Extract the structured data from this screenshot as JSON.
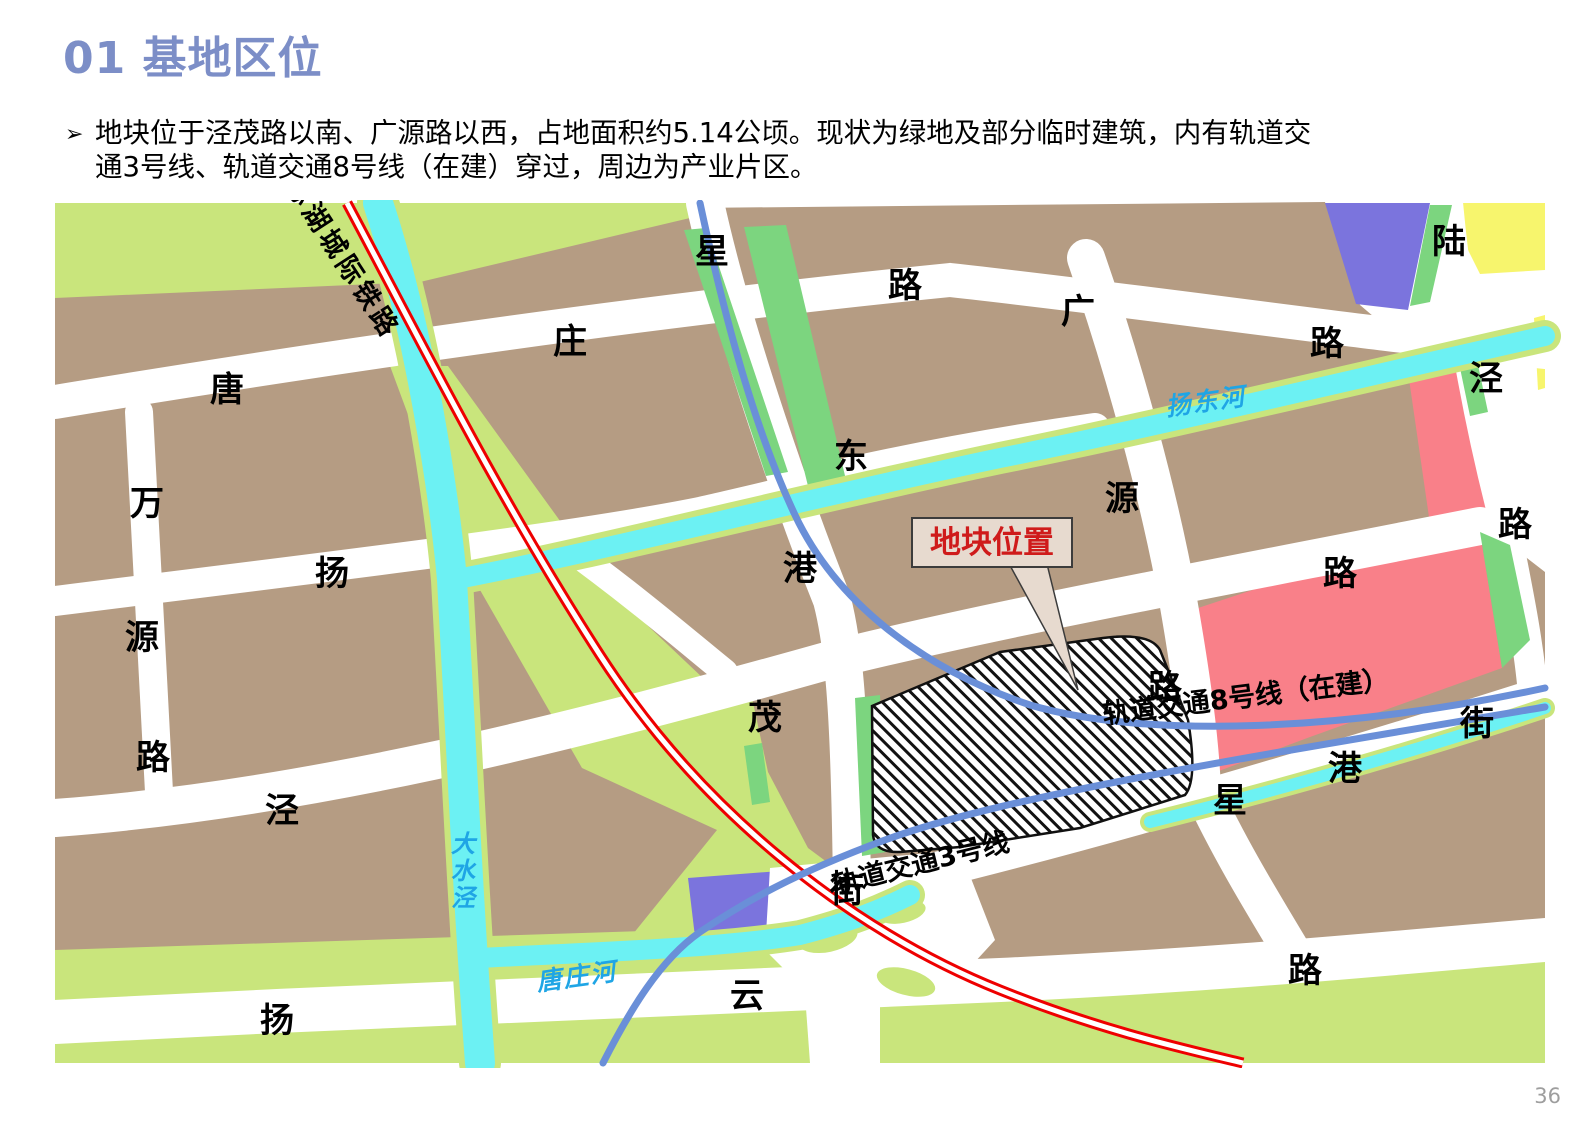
{
  "page": {
    "title": "01 基地区位",
    "bullet_marker": "➢",
    "bullet_line1": "地块位于泾茂路以南、广源路以西，占地面积约5.14公顷。现状为绿地及部分临时建筑，内有轨道交",
    "bullet_line2": "通3号线、轨道交通8号线（在建）穿过，周边为产业片区。",
    "page_number": "36"
  },
  "colors": {
    "title_blue": "#7c8ec7",
    "block_brown": "#b59c83",
    "olive_green": "#c9e57c",
    "strip_green": "#7cd57f",
    "river_cyan": "#6cf1f3",
    "metro_blue": "#6a8fd8",
    "rail_red": "#ee0000",
    "zone_pink": "#f98089",
    "zone_purple": "#7b74dd",
    "zone_yellow": "#f7f56d",
    "callout_bg": "#e7dacf",
    "callout_red": "#cf1b1b",
    "water_label_blue": "#1fa5e5"
  },
  "map": {
    "callout": {
      "text": "地块位置"
    },
    "labels": [
      {
        "name": "rail-label",
        "text": "如通苏湖城际铁路",
        "x": 318,
        "y": 237,
        "size": 27,
        "rot": 57,
        "cls": "rlabel",
        "spacing": 4
      },
      {
        "name": "metro8-label",
        "text": "轨道交通8号线（在建）",
        "x": 1247,
        "y": 706,
        "size": 27,
        "rot": -7,
        "cls": "rlabel",
        "spacing": 0
      },
      {
        "name": "metro3-label",
        "text": "轨道交通3号线",
        "x": 923,
        "y": 872,
        "size": 27,
        "rot": -14,
        "cls": "rlabel",
        "spacing": 0
      },
      {
        "name": "river-label-yangdong",
        "text": "扬东河",
        "x": 1207,
        "y": 410,
        "size": 25,
        "rot": -8,
        "cls": "water",
        "spacing": 2
      },
      {
        "name": "river-label-dashuijing",
        "text": "大水泾",
        "x": 463,
        "y": 852,
        "size": 24,
        "rot": 0,
        "cls": "water",
        "stack": 27
      },
      {
        "name": "river-label-tangzhuang",
        "text": "唐庄河",
        "x": 578,
        "y": 985,
        "size": 25,
        "rot": -8,
        "cls": "water",
        "spacing": 2
      },
      {
        "name": "road-label",
        "text": "星",
        "x": 712,
        "y": 263,
        "size": 34,
        "cls": "rlabel"
      },
      {
        "name": "road-label",
        "text": "路",
        "x": 905,
        "y": 297,
        "size": 34,
        "cls": "rlabel"
      },
      {
        "name": "road-label",
        "text": "庄",
        "x": 570,
        "y": 353,
        "size": 34,
        "cls": "rlabel"
      },
      {
        "name": "road-label",
        "text": "广",
        "x": 1078,
        "y": 323,
        "size": 34,
        "cls": "rlabel"
      },
      {
        "name": "road-label",
        "text": "陆",
        "x": 1449,
        "y": 253,
        "size": 34,
        "cls": "rlabel"
      },
      {
        "name": "road-label",
        "text": "路",
        "x": 1327,
        "y": 355,
        "size": 34,
        "cls": "rlabel"
      },
      {
        "name": "road-label",
        "text": "唐",
        "x": 227,
        "y": 401,
        "size": 34,
        "cls": "rlabel"
      },
      {
        "name": "road-label",
        "text": "泾",
        "x": 1486,
        "y": 390,
        "size": 34,
        "cls": "rlabel"
      },
      {
        "name": "road-label",
        "text": "东",
        "x": 851,
        "y": 468,
        "size": 34,
        "cls": "rlabel"
      },
      {
        "name": "road-label",
        "text": "源",
        "x": 1122,
        "y": 510,
        "size": 34,
        "cls": "rlabel"
      },
      {
        "name": "road-label",
        "text": "万",
        "x": 147,
        "y": 515,
        "size": 34,
        "cls": "rlabel"
      },
      {
        "name": "road-label",
        "text": "港",
        "x": 800,
        "y": 580,
        "size": 34,
        "cls": "rlabel"
      },
      {
        "name": "road-label",
        "text": "路",
        "x": 1515,
        "y": 536,
        "size": 34,
        "cls": "rlabel"
      },
      {
        "name": "road-label",
        "text": "扬",
        "x": 332,
        "y": 585,
        "size": 34,
        "cls": "rlabel"
      },
      {
        "name": "road-label",
        "text": "路",
        "x": 1340,
        "y": 585,
        "size": 34,
        "cls": "rlabel"
      },
      {
        "name": "road-label",
        "text": "源",
        "x": 142,
        "y": 649,
        "size": 34,
        "cls": "rlabel"
      },
      {
        "name": "road-label",
        "text": "路",
        "x": 1165,
        "y": 699,
        "size": 34,
        "cls": "rlabel"
      },
      {
        "name": "road-label",
        "text": "茂",
        "x": 765,
        "y": 729,
        "size": 34,
        "cls": "rlabel"
      },
      {
        "name": "road-label",
        "text": "街",
        "x": 1477,
        "y": 735,
        "size": 34,
        "cls": "rlabel"
      },
      {
        "name": "road-label",
        "text": "路",
        "x": 153,
        "y": 769,
        "size": 34,
        "cls": "rlabel"
      },
      {
        "name": "road-label",
        "text": "港",
        "x": 1345,
        "y": 780,
        "size": 34,
        "cls": "rlabel"
      },
      {
        "name": "road-label",
        "text": "泾",
        "x": 282,
        "y": 822,
        "size": 34,
        "cls": "rlabel"
      },
      {
        "name": "road-label",
        "text": "星",
        "x": 1230,
        "y": 812,
        "size": 34,
        "cls": "rlabel"
      },
      {
        "name": "road-label",
        "text": "街",
        "x": 847,
        "y": 902,
        "size": 34,
        "cls": "rlabel"
      },
      {
        "name": "road-label",
        "text": "路",
        "x": 1305,
        "y": 982,
        "size": 34,
        "cls": "rlabel"
      },
      {
        "name": "road-label",
        "text": "云",
        "x": 747,
        "y": 1007,
        "size": 34,
        "cls": "rlabel"
      },
      {
        "name": "road-label",
        "text": "扬",
        "x": 277,
        "y": 1032,
        "size": 34,
        "cls": "rlabel"
      }
    ]
  }
}
